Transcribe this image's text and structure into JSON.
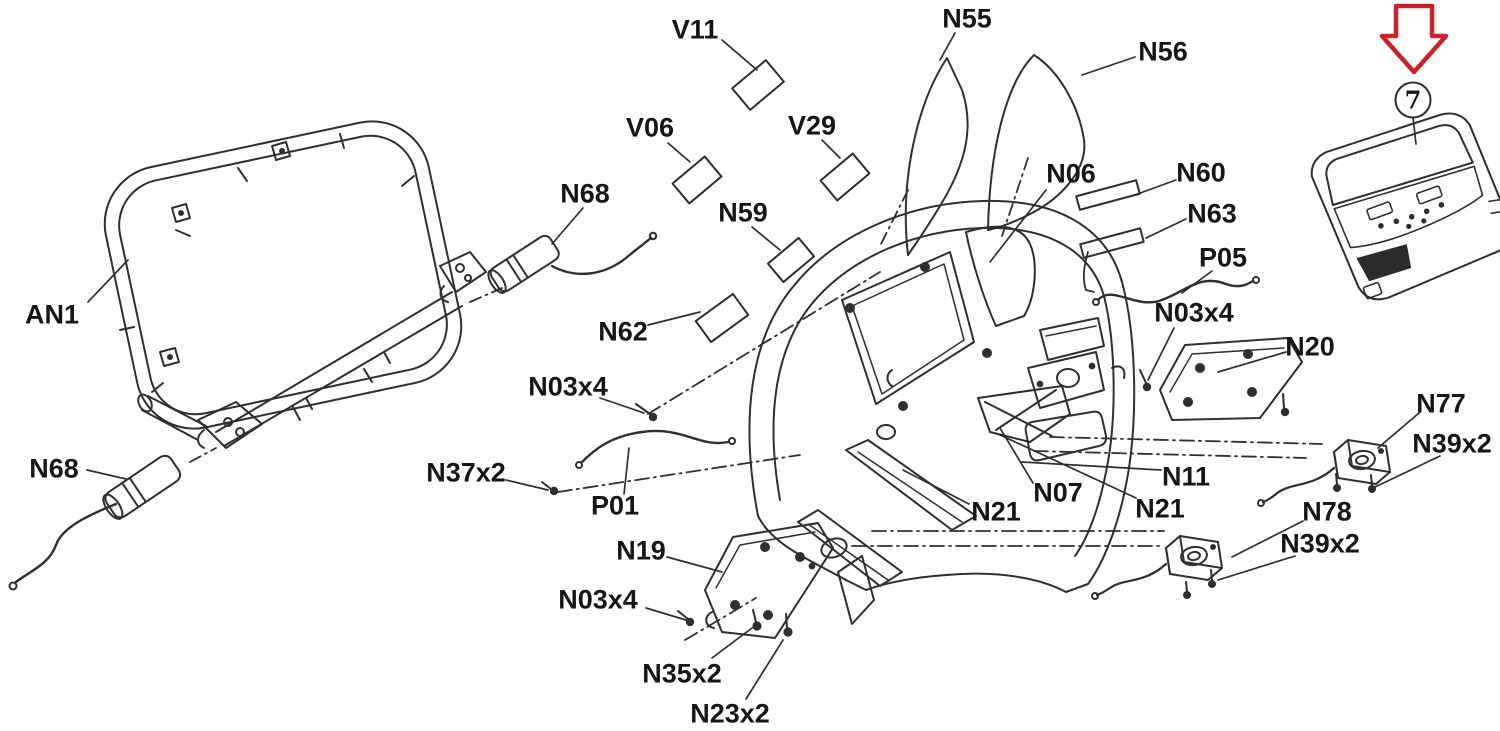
{
  "diagram": {
    "type": "exploded-parts-diagram",
    "subject": "treadmill-console-assembly",
    "callout_number": "7",
    "accent_color": "#c8232b",
    "line_color": "#2f2f2f",
    "background_color": "#ffffff"
  },
  "labels": [
    {
      "text": "V11",
      "x": 695,
      "y": 30
    },
    {
      "text": "N55",
      "x": 967,
      "y": 19
    },
    {
      "text": "N56",
      "x": 1163,
      "y": 52
    },
    {
      "text": "V06",
      "x": 650,
      "y": 128
    },
    {
      "text": "V29",
      "x": 812,
      "y": 126
    },
    {
      "text": "N68",
      "x": 585,
      "y": 194
    },
    {
      "text": "N59",
      "x": 743,
      "y": 213
    },
    {
      "text": "N06",
      "x": 1071,
      "y": 174
    },
    {
      "text": "N60",
      "x": 1201,
      "y": 173
    },
    {
      "text": "N63",
      "x": 1212,
      "y": 214
    },
    {
      "text": "P05",
      "x": 1223,
      "y": 258
    },
    {
      "text": "AN1",
      "x": 52,
      "y": 315
    },
    {
      "text": "N62",
      "x": 623,
      "y": 332
    },
    {
      "text": "N03x4",
      "x": 568,
      "y": 387
    },
    {
      "text": "N03x4",
      "x": 1194,
      "y": 313
    },
    {
      "text": "N20",
      "x": 1310,
      "y": 347
    },
    {
      "text": "N68",
      "x": 54,
      "y": 469
    },
    {
      "text": "N37x2",
      "x": 466,
      "y": 473
    },
    {
      "text": "P01",
      "x": 615,
      "y": 506
    },
    {
      "text": "N07",
      "x": 1058,
      "y": 493
    },
    {
      "text": "N11",
      "x": 1186,
      "y": 477
    },
    {
      "text": "N21",
      "x": 996,
      "y": 512
    },
    {
      "text": "N21",
      "x": 1160,
      "y": 509
    },
    {
      "text": "N77",
      "x": 1441,
      "y": 404
    },
    {
      "text": "N39x2",
      "x": 1452,
      "y": 444
    },
    {
      "text": "N78",
      "x": 1327,
      "y": 512
    },
    {
      "text": "N39x2",
      "x": 1320,
      "y": 544
    },
    {
      "text": "N19",
      "x": 641,
      "y": 551
    },
    {
      "text": "N03x4",
      "x": 598,
      "y": 600
    },
    {
      "text": "N35x2",
      "x": 682,
      "y": 674
    },
    {
      "text": "N23x2",
      "x": 730,
      "y": 714
    }
  ]
}
